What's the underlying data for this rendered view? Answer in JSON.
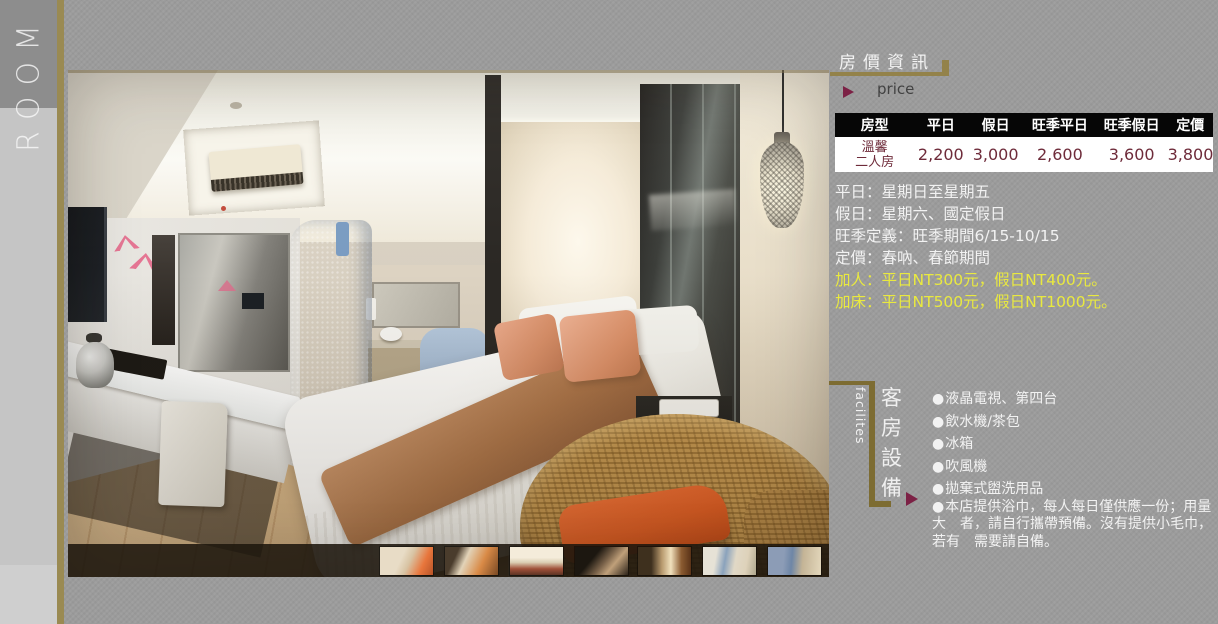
{
  "sidebar": {
    "room_label": "ROOM"
  },
  "price_section": {
    "title": "房價資訊",
    "subtitle": "price",
    "table": {
      "headers": [
        "房型",
        "平日",
        "假日",
        "旺季平日",
        "旺季假日",
        "定價"
      ],
      "rows": [
        {
          "room_type_lines": [
            "溫馨",
            "二人房"
          ],
          "values": [
            "2,200",
            "3,000",
            "2,600",
            "3,600",
            "3,800"
          ]
        }
      ]
    },
    "notes": [
      "平日：星期日至星期五",
      "假日：星期六、國定假日",
      "旺季定義：旺季期間6/15-10/15",
      "定價：春吶、春節期間"
    ],
    "highlight_notes": [
      "加人：平日NT300元，假日NT400元。",
      "加床：平日NT500元，假日NT1000元。"
    ]
  },
  "facilities_section": {
    "label_en": "facilites",
    "label_zh": "客房設備",
    "bullet": "●",
    "items": [
      "液晶電視、第四台",
      "飲水機/茶包",
      "冰箱",
      "吹風機",
      "拋棄式盥洗用品",
      "本店提供浴巾，每人每日僅供應一份；用量大　者，請自行攜帶預備。沒有提供小毛巾，若有　需要請自備。"
    ]
  },
  "gallery": {
    "thumbnails": [
      "room-view-1",
      "room-view-2",
      "room-view-3",
      "room-view-4",
      "room-entry-view",
      "bathroom-view-1",
      "bathroom-view-2"
    ]
  },
  "colors": {
    "background": "#9c9c9c",
    "gold_accent": "#93824a",
    "maroon_accent": "#7c2145",
    "highlight_yellow": "#e9e93f",
    "table_text": "#6e2b3a",
    "table_header_bg": "#060606"
  }
}
